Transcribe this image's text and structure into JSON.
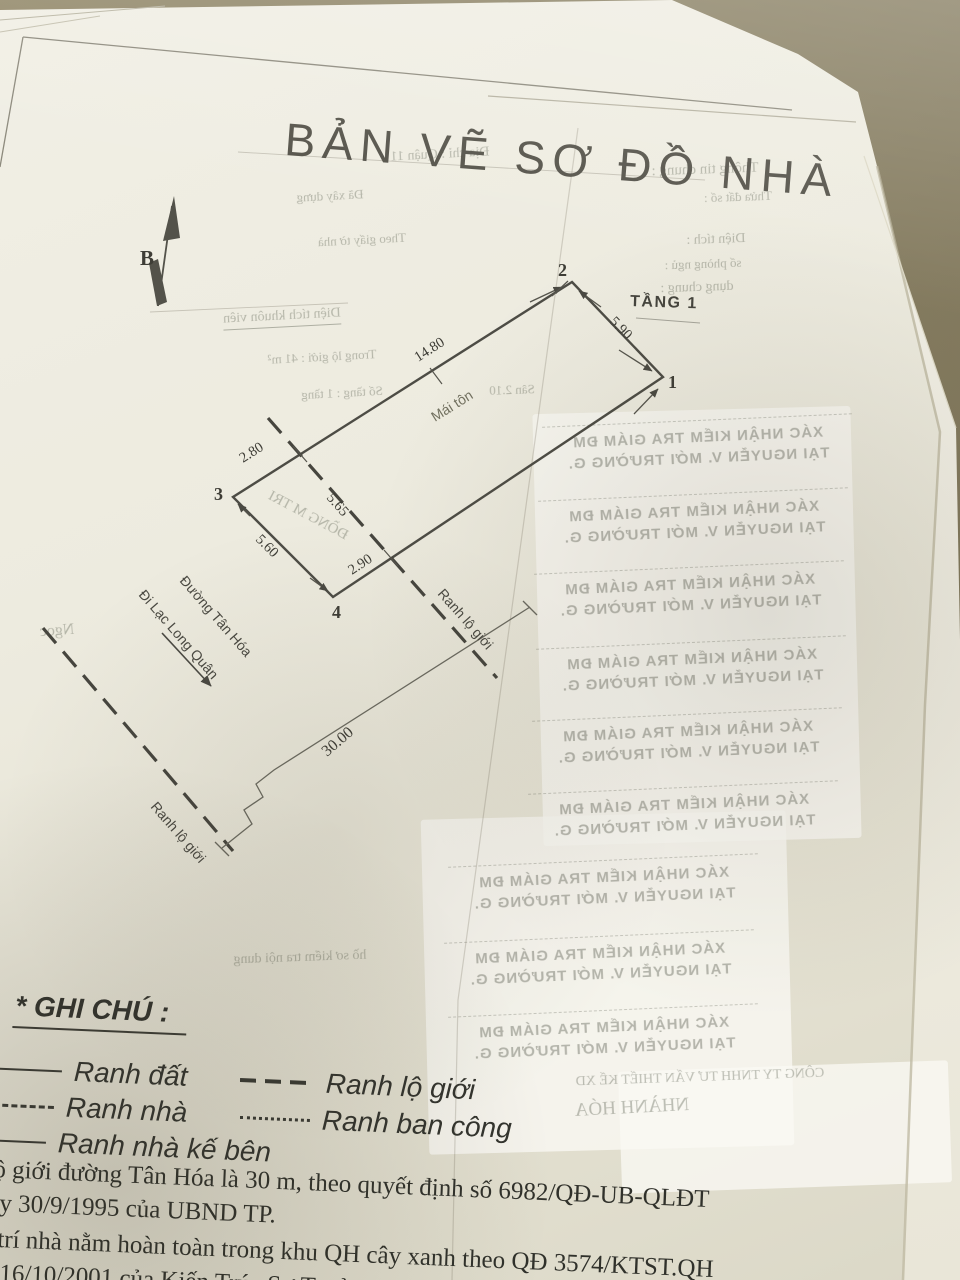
{
  "document": {
    "title": "BẢN VẼ SƠ ĐỒ NHÀ",
    "floor_label": "TẦNG 1",
    "north_label": "B"
  },
  "plan": {
    "corners": [
      "1",
      "2",
      "3",
      "4"
    ],
    "dimensions": {
      "front_2_1": "5.90",
      "side_upper": "14.80",
      "side_upper_road": "2.80",
      "road_cut": "5.65",
      "back_3_4": "5.60",
      "side_lower_road": "2.90",
      "road_width": "30.00"
    },
    "roof_label": "Mái tôn",
    "street_main": "Đường Tân Hóa",
    "street_direction": "Đi Lạc Long Quân",
    "boundary_label": "Ranh lộ giới"
  },
  "legend": {
    "heading": "* GHI CHÚ :",
    "items": [
      {
        "label": "Ranh đất",
        "style": "solid"
      },
      {
        "label": "Ranh nhà",
        "style": "dashed"
      },
      {
        "label": "Ranh nhà kế bên",
        "style": "solid"
      },
      {
        "label": "Ranh lộ giới",
        "style": "heavy-dash"
      },
      {
        "label": "Ranh ban công",
        "style": "dotted"
      }
    ]
  },
  "notes": {
    "line1": "ộ giới đường Tân Hóa là 30 m, theo quyết định số 6982/QĐ-UB-QLĐT",
    "line2": "y 30/9/1995 của UBND TP.",
    "line3": "trí nhà nằm hoàn toàn trong khu QH cây xanh theo QĐ 3574/KTST.QH",
    "line4": "16/10/2001 của Kiến Trúc Sư Trưởng TP."
  },
  "bleed_through": {
    "items": [
      {
        "text": "Thông tin chung :"
      },
      {
        "text": "Thửa đất số :"
      },
      {
        "text": "Diện tích :"
      },
      {
        "text": "số phòng ngủ :"
      },
      {
        "text": "dụng chung :"
      },
      {
        "text": "Địa chỉ : Quận 11"
      },
      {
        "text": "Đã xây dựng"
      },
      {
        "text": "Theo giấy tờ nhà"
      },
      {
        "text": "Diện tích khuôn viên"
      },
      {
        "text": "Trong lộ giới : 41 m²"
      },
      {
        "text": "Số tầng : 1 tầng"
      },
      {
        "text": "Ngọc"
      },
      {
        "text": "Sân 2.10"
      },
      {
        "text": "ĐỒNG M TRI"
      },
      {
        "text": "hồ sơ kiểm tra nội dung"
      },
      {
        "text": "CÔNG TY TNHH TƯ VẤN THIẾT KẾ XD"
      },
      {
        "text": "NHÀNH HÓA"
      }
    ],
    "stamp": {
      "line1": "XÁC NHẬN KIỂM TRA GIÁM ĐM",
      "line2": "TẠI NGUYỄN V. MỚI TRƯỜNG G."
    }
  },
  "colors": {
    "table_background": "#877E62",
    "paper": "#ECEADE",
    "ink": "#4B4A44"
  }
}
